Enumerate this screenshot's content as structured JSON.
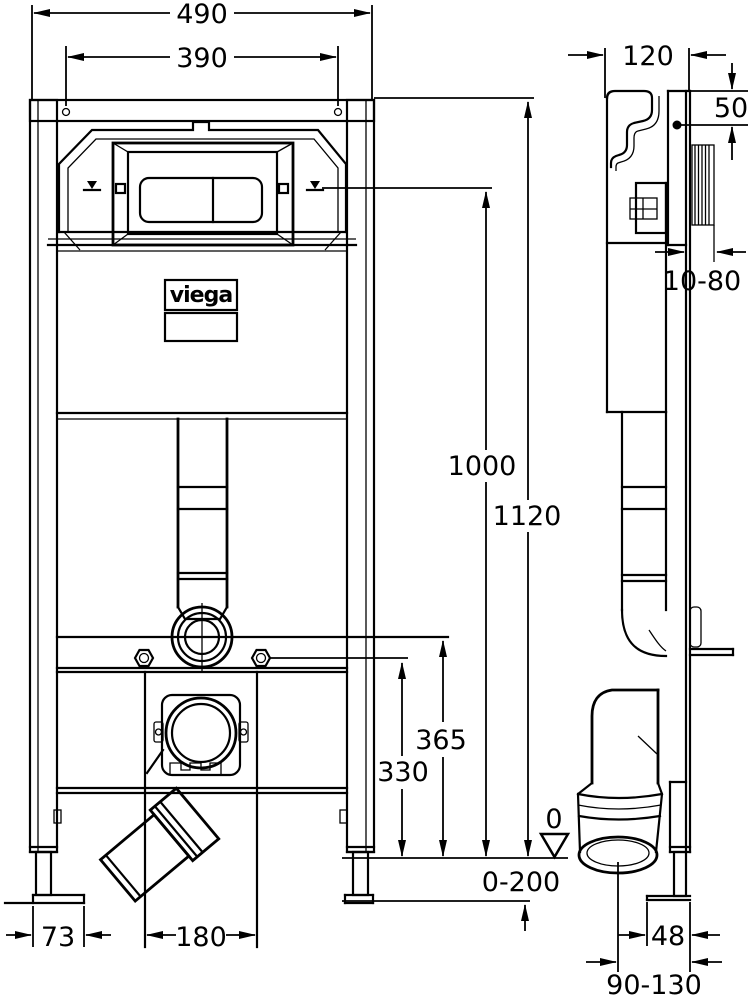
{
  "drawing": {
    "brand": "viega",
    "dims": {
      "overall_width": "490",
      "fixing_hole_spacing": "390",
      "frame_depth": "120",
      "top_fixing_offset": "50",
      "wall_clearance": "10-80",
      "actuation_height": "1000",
      "frame_height": "1120",
      "water_supply_height": "365",
      "fixing_height": "330",
      "datum_zero": "0",
      "floor_buildup": "0-200",
      "foot_plate_width": "73",
      "fixing_rail_spacing": "180",
      "foot_plate_depth": "48",
      "outlet_wall_distance": "90-130"
    }
  }
}
